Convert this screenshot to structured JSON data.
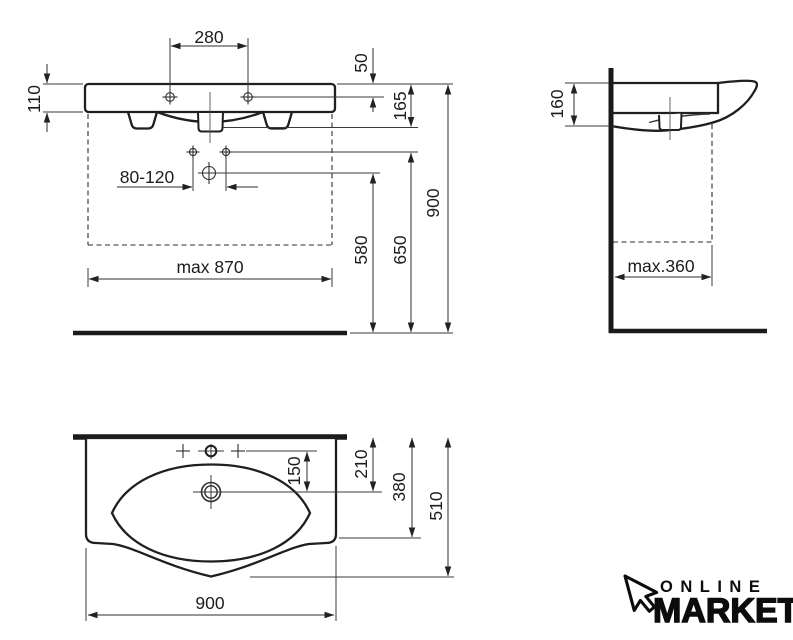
{
  "drawing": {
    "title": "washbasin technical dimension drawing",
    "front_view": {
      "dim_tap_spacing": "280",
      "dim_rim_to_tap": "50",
      "dim_fascia_height": "110",
      "dim_rim_to_outlet": "165",
      "dim_fixing_holes": "80-120",
      "dim_max_width": "max 870",
      "dim_drain_height": "580",
      "dim_fixing_height": "650",
      "dim_rim_height": "900"
    },
    "side_view": {
      "dim_front_height": "160",
      "dim_max_depth": "max.360"
    },
    "top_view": {
      "dim_tap_to_drain": "150",
      "dim_wall_to_drain": "210",
      "dim_side_depth": "380",
      "dim_total_depth": "510",
      "dim_width": "900"
    },
    "logo": {
      "line1": "ONLINE",
      "line2": "MARKET"
    },
    "colors": {
      "line": "#1f1f1f",
      "thin_line": "#3a3a3a",
      "background": "#ffffff"
    }
  }
}
